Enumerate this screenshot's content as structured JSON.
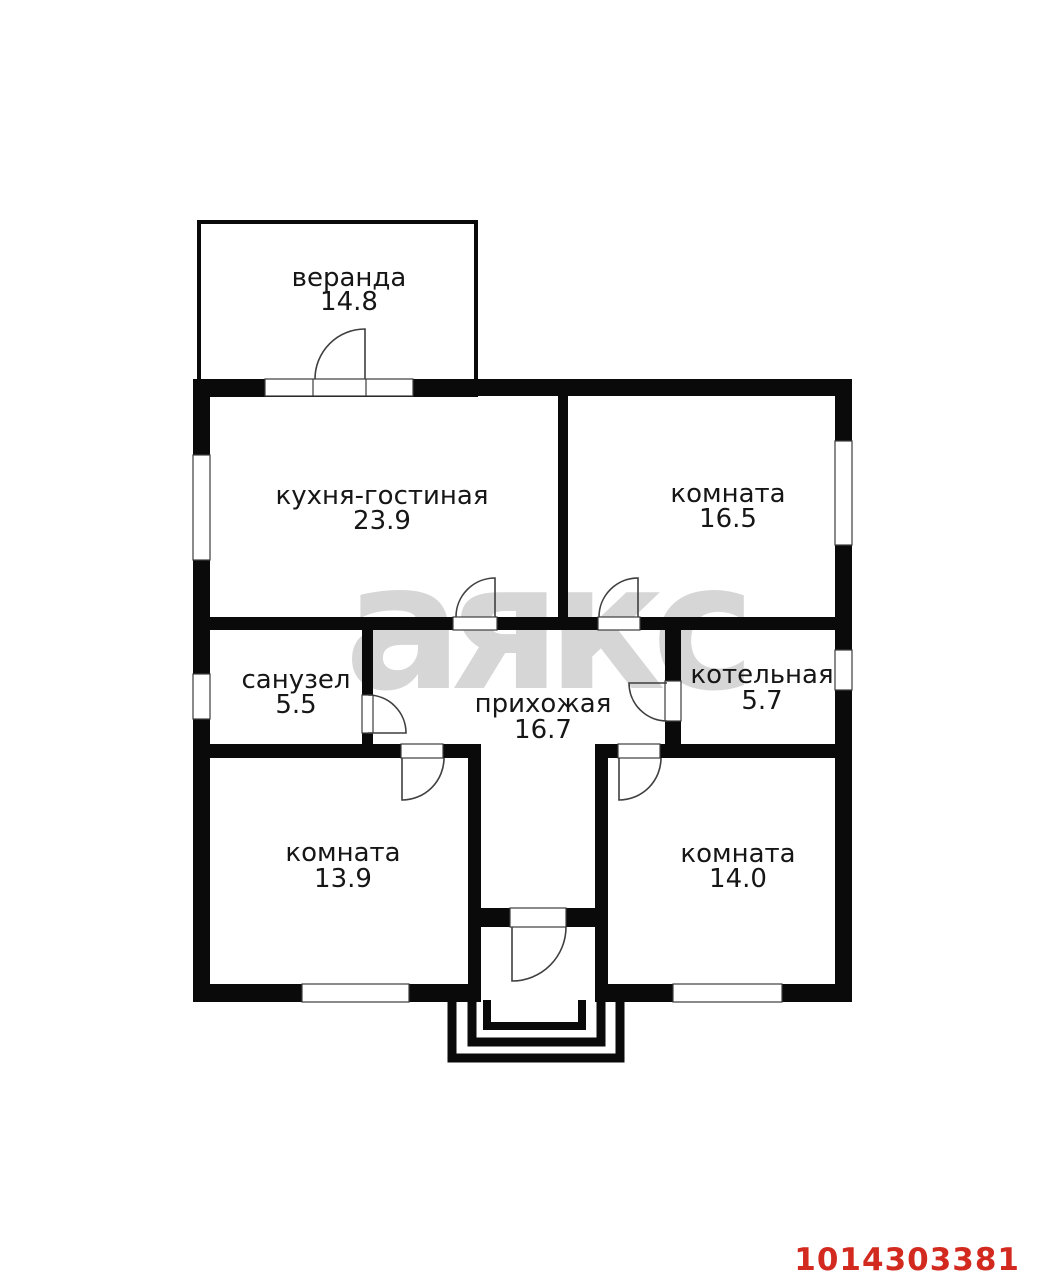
{
  "watermark": "аякс",
  "listing_id": "1014303381",
  "colors": {
    "wall": "#0a0a0a",
    "background": "#ffffff",
    "watermark": "#d6d6d6",
    "listing_id": "#d32a20",
    "label": "#161616"
  },
  "rooms": [
    {
      "id": "veranda",
      "name": "веранда",
      "area": "14.8"
    },
    {
      "id": "kitchen-living",
      "name": "кухня-гостиная",
      "area": "23.9"
    },
    {
      "id": "room-top-right",
      "name": "комната",
      "area": "16.5"
    },
    {
      "id": "bathroom",
      "name": "санузел",
      "area": "5.5"
    },
    {
      "id": "hallway",
      "name": "прихожая",
      "area": "16.7"
    },
    {
      "id": "boiler-room",
      "name": "котельная",
      "area": "5.7"
    },
    {
      "id": "room-bottom-left",
      "name": "комната",
      "area": "13.9"
    },
    {
      "id": "room-bottom-right",
      "name": "комната",
      "area": "14.0"
    }
  ]
}
